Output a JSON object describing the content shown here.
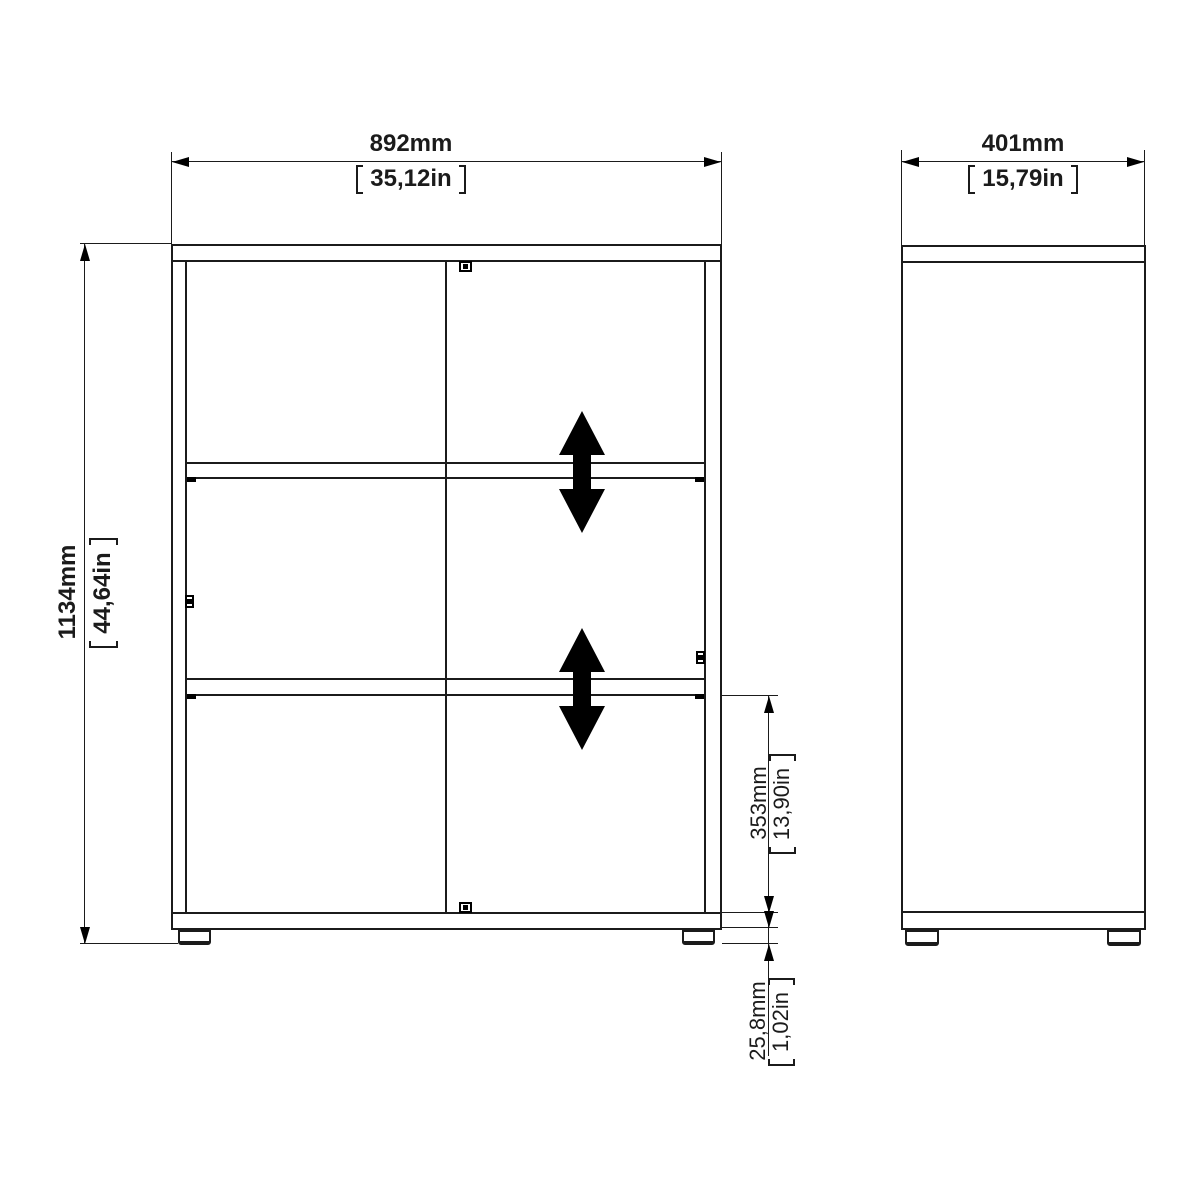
{
  "diagram": {
    "type": "furniture-technical-drawing",
    "views": {
      "front": "front-view",
      "side": "side-view"
    }
  },
  "colors": {
    "line": "#1b1b1b",
    "fill": "#000000",
    "background": "#ffffff"
  },
  "icons": {
    "adjustable_shelf_arrow": "double-vertical-arrow",
    "cam_lock": "cam-lock-fastener",
    "shelf_pin": "shelf-pin-tick"
  },
  "dimensions": {
    "overall_width": {
      "mm": "892mm",
      "inch": "35,12in"
    },
    "overall_depth": {
      "mm": "401mm",
      "inch": "15,79in"
    },
    "overall_height": {
      "mm": "1134mm",
      "inch": "44,64in"
    },
    "bottom_section_height": {
      "mm": "353mm",
      "inch": "13,90in"
    },
    "foot_height": {
      "mm": "25,8mm",
      "inch": "1,02in"
    }
  }
}
